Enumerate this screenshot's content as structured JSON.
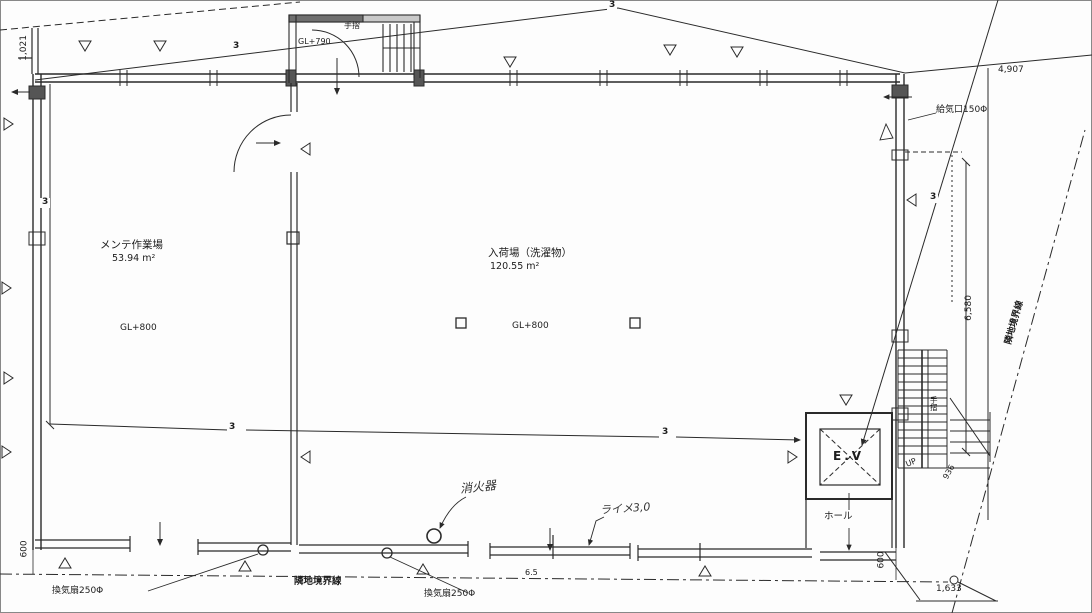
{
  "drawing": {
    "rooms": [
      {
        "name": "メンテ作業場",
        "area": "53.94 m²",
        "level": "GL+800"
      },
      {
        "name": "入荷場（洗濯物）",
        "area": "120.55 m²",
        "level": "GL+800"
      }
    ],
    "vestibule": {
      "level": "GL+790",
      "handrail": "手摺"
    },
    "elevator": {
      "label": "E.V"
    },
    "hall": {
      "label": "ホール"
    },
    "stairs": {
      "up": "UP",
      "handrail": "手摺",
      "width": "936"
    },
    "dimensions": {
      "top_left": "1,021",
      "top_right": "4,907",
      "right_height": "6,580",
      "bottom_right": "1,633",
      "bottom_left_600": "600",
      "bottom_right_600": "600",
      "boundary_mid": "6.5"
    },
    "annotations": {
      "supply_air": "給気口150Φ",
      "fan": "換気扇250Φ",
      "boundary_bottom": "隣地境界線",
      "boundary_right": "隣地境界線",
      "fire_extinguisher": "消火器",
      "handwritten_note": "ライメ3,0",
      "section_mark": "3"
    },
    "colors": {
      "paper": "#fdfdfd",
      "ink": "#2a2a2a"
    }
  }
}
